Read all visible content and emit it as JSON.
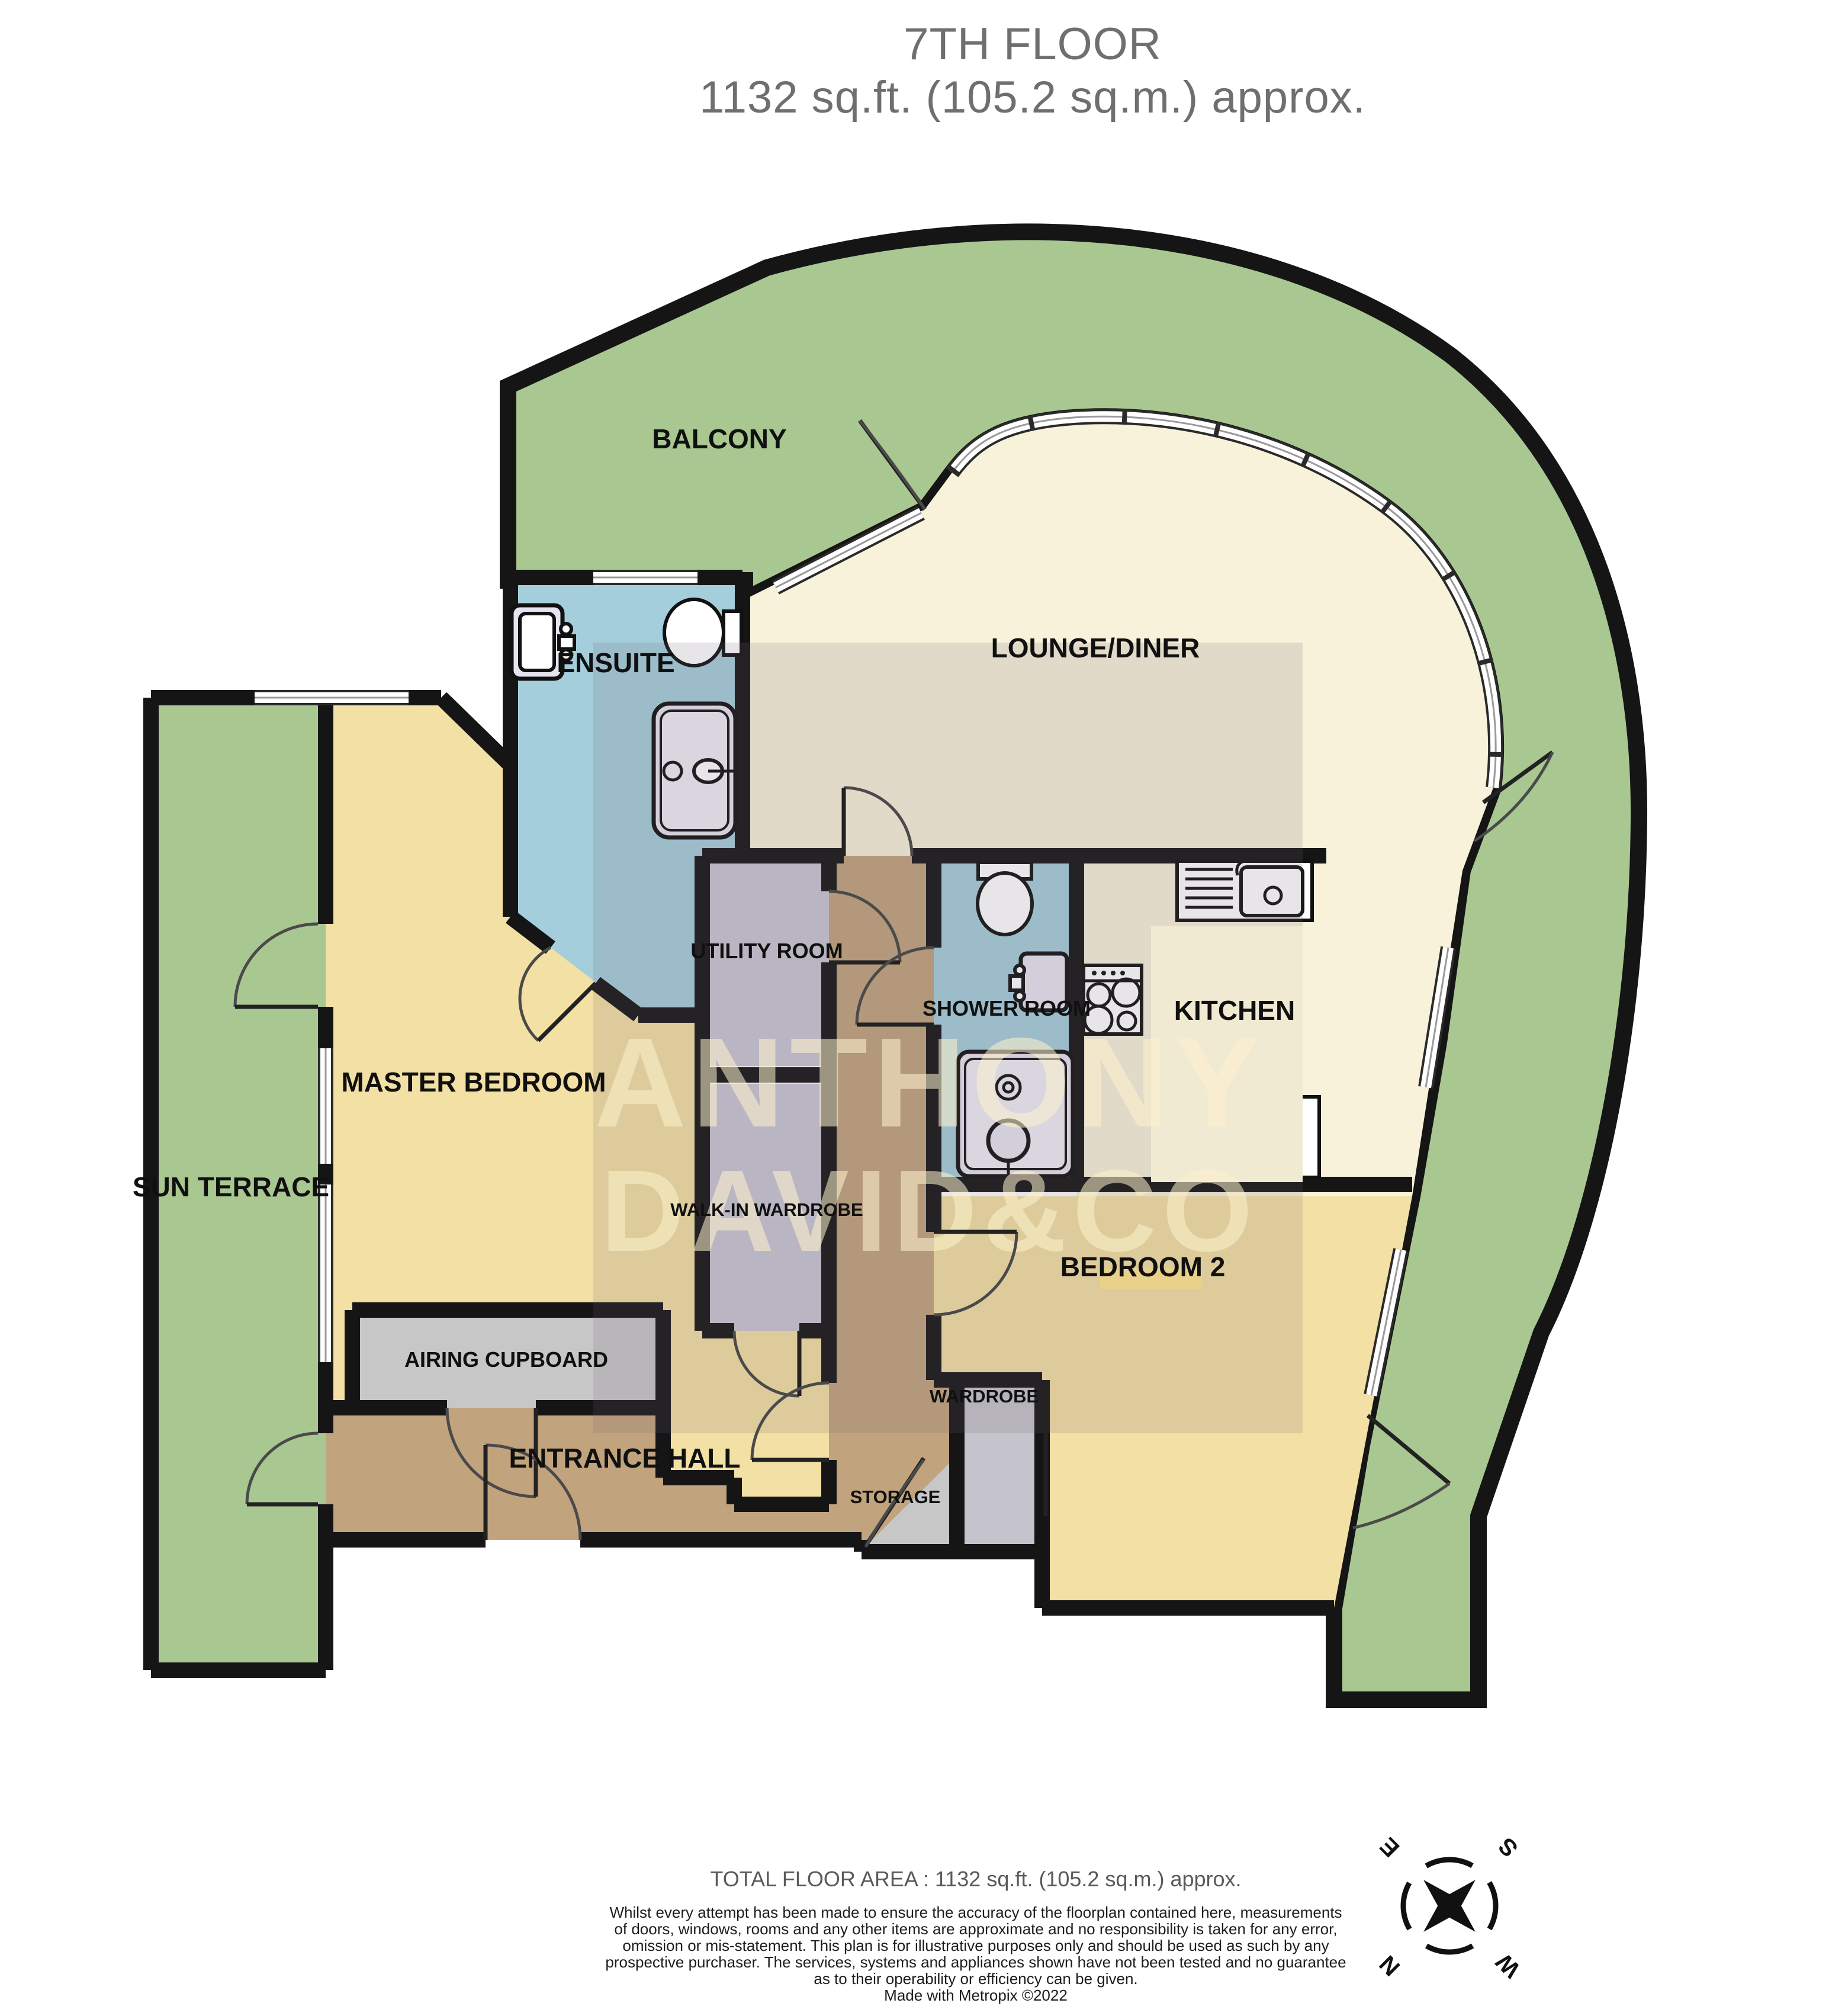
{
  "title": {
    "line1": "7TH FLOOR",
    "line2": "1132 sq.ft. (105.2 sq.m.) approx."
  },
  "watermark": {
    "line1": "ANTHONY",
    "line2": "DAVID&CO"
  },
  "rooms": {
    "balcony": "BALCONY",
    "ensuite": "ENSUITE",
    "lounge": "LOUNGE/DINER",
    "utility": "UTILITY ROOM",
    "shower": "SHOWER ROOM",
    "kitchen": "KITCHEN",
    "master": "MASTER BEDROOM",
    "terrace": "SUN TERRACE",
    "walkin": "WALK-IN WARDROBE",
    "bedroom2": "BEDROOM 2",
    "airing": "AIRING CUPBOARD",
    "hall": "ENTRANCE HALL",
    "wardrobe": "WARDROBE",
    "storage": "STORAGE"
  },
  "compass": {
    "n": "N",
    "e": "E",
    "s": "S",
    "w": "W"
  },
  "icons": {
    "snowflake": "❄"
  },
  "footer": {
    "total": "TOTAL FLOOR AREA : 1132 sq.ft. (105.2 sq.m.) approx.",
    "disclaimer_lines": [
      "Whilst every attempt has been made to ensure the accuracy of the floorplan contained here, measurements",
      "of doors, windows, rooms and any other items are approximate and no responsibility is taken for any error,",
      "omission or mis-statement. This plan is for illustrative purposes only and should be used as such by any",
      "prospective purchaser. The services, systems and appliances shown have not been tested and no guarantee",
      "as to their operability or efficiency can be given."
    ],
    "credit": "Made with Metropix ©2022"
  },
  "colors": {
    "outdoor_green": "#a9c791",
    "room_cream": "#f8f2da",
    "bedroom_yellow": "#f3e0a4",
    "bathroom_blue": "#a5cedd",
    "hall_brown": "#c1a37d",
    "closet_lavender": "#c9c6d3",
    "cupboard_gray": "#c7c7c7",
    "wall_black": "#151515",
    "title_gray": "#6f6f6f"
  }
}
